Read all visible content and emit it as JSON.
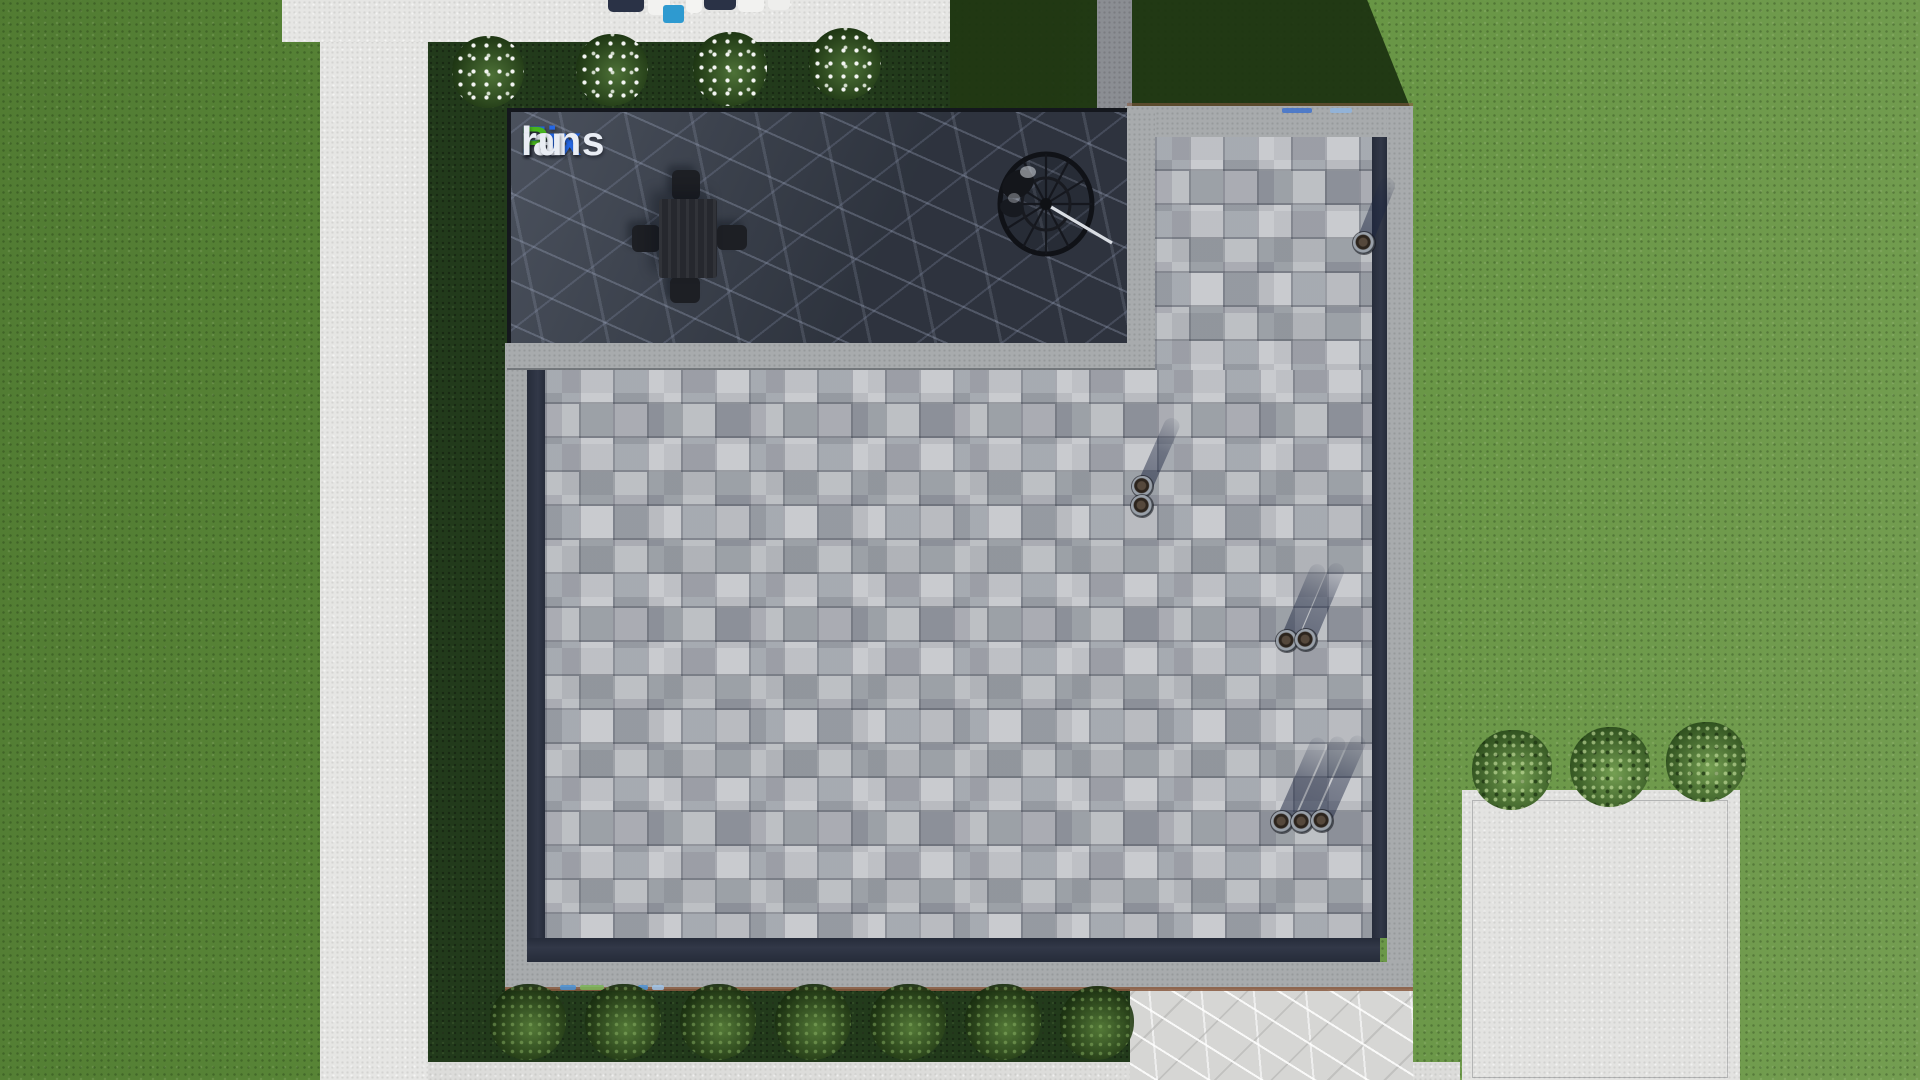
{
  "scene": {
    "title": "Aerial top-down 3D render of a modern flat-roof house plot",
    "source_watermark": "FixPlans.ru"
  },
  "watermark": {
    "segments": [
      {
        "text": "Fix",
        "color": "#2567e4"
      },
      {
        "text": "P",
        "color": "#47b41e"
      },
      {
        "text": "lans",
        "color": "#e9edf4"
      },
      {
        "text": ".",
        "color": "#2567e4"
      },
      {
        "text": "ru",
        "color": "#e9edf4"
      }
    ]
  },
  "palette": {
    "lawn": "#5f8f3b",
    "lawn_bright": "#6d9d45",
    "lawn_shadow": "#1d3311",
    "planting_bed": "#223a1b",
    "walkway_concrete": "#e6e6e4",
    "walkway_shadowed": "#8b8e93",
    "concrete_pad": "#e3e3e1",
    "marble_path_light": "#d7d7d5",
    "terrace_stone_dark": "#39404d",
    "terrace_vein": "#aab3c6",
    "shingle_base": "#b4b7bc",
    "shingle_dark": "#8f939b",
    "roof_coping": "#a8abad",
    "roof_gutter": "#2b3140",
    "rust_trim": "#8a5a40",
    "furniture_dark": "#1d1f24",
    "metal_arm": "#d9dde3",
    "pool_blue": "#2e9ad0"
  },
  "objects": [
    {
      "name": "dining-table-set",
      "count": 1
    },
    {
      "name": "hanging-egg-chair",
      "count": 1
    },
    {
      "name": "roof-vent-pipe",
      "count": 8
    },
    {
      "name": "flowering-bush",
      "count": 4
    },
    {
      "name": "green-bush",
      "count": 3
    },
    {
      "name": "hedge-bush",
      "count": 7
    },
    {
      "name": "patio-lounger",
      "count": 4
    }
  ]
}
